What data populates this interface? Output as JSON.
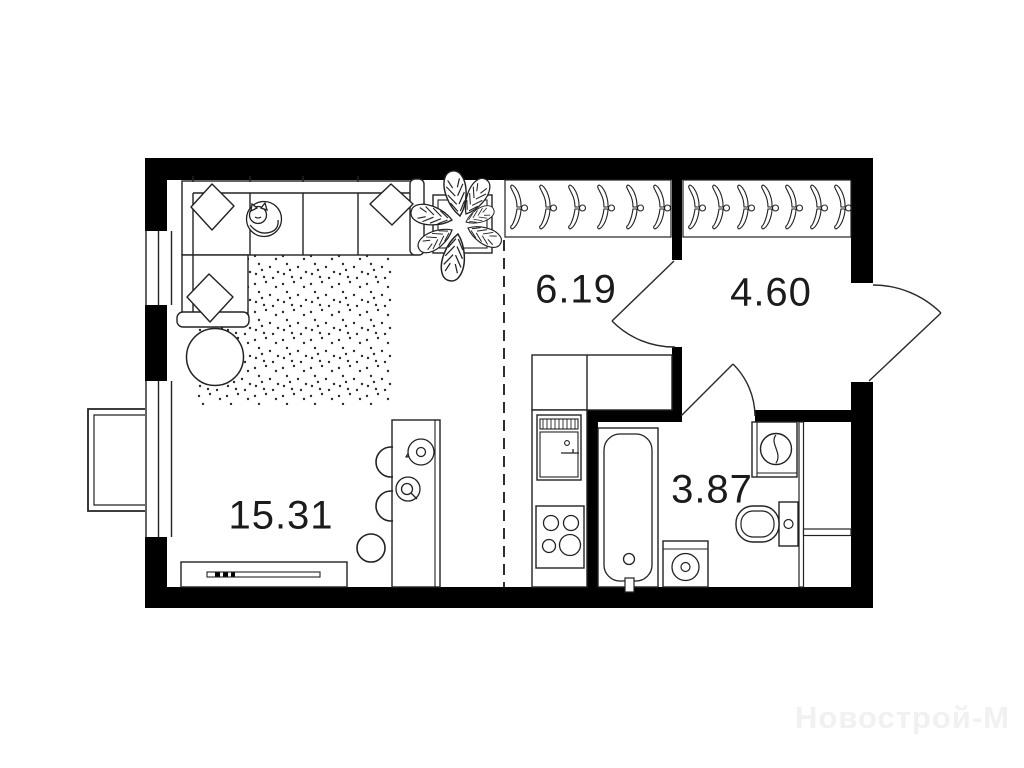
{
  "background": "#ffffff",
  "palette": {
    "wall": "#000000",
    "line": "#222222",
    "label": "#1b1b1b",
    "watermark": "#f1f1f1"
  },
  "rooms": {
    "living_room": {
      "area": "15.31"
    },
    "kitchen": {
      "area": "6.19"
    },
    "hallway": {
      "area": "4.60"
    },
    "bathroom": {
      "area": "3.87"
    }
  },
  "wardrobe": {
    "left_hanger_count": 6,
    "right_hanger_count": 7
  },
  "watermark": {
    "text": "Новострой-М"
  },
  "furniture_icons": [
    "corner-sofa-icon",
    "pillow-icon",
    "sleeping-cat-icon",
    "dotted-rug-icon",
    "coffee-table-icon",
    "potted-plant-icon",
    "hanger-icon",
    "dining-table-icon",
    "chair-icon",
    "tv-console-icon",
    "kitchen-counter-icon",
    "kitchen-sink-icon",
    "cooktop-icon",
    "bathtub-icon",
    "washing-machine-icon",
    "toilet-icon",
    "washbasin-icon",
    "door-swing-icon",
    "window-icon",
    "balcony-basket-icon"
  ]
}
